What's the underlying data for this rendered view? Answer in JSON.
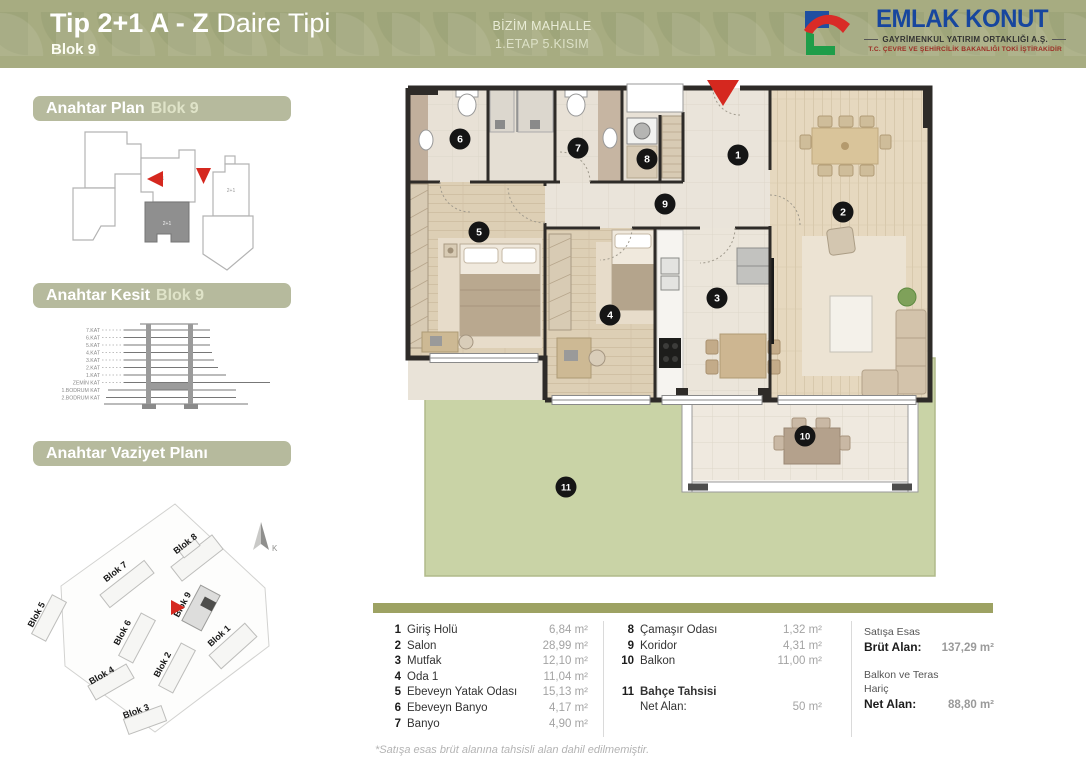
{
  "header": {
    "title_bold": "Tip 2+1 A - Z",
    "title_light": "Daire Tipi",
    "block": "Blok 9",
    "project_line1": "BİZİM MAHALLE",
    "project_line2": "1.ETAP 5.KISIM",
    "background_color": "#a7ac81",
    "logo": {
      "brand": "EMLAK KONUT",
      "subtitle": "GAYRİMENKUL YATIRIM ORTAKLIĞI A.Ş.",
      "tagline": "T.C. ÇEVRE VE ŞEHİRCİLİK BAKANLIĞI TOKİ İŞTİRAKİDİR"
    }
  },
  "sidebar": {
    "key_plan": {
      "title": "Anahtar Plan",
      "block": "Blok 9",
      "unit_labels": [
        "2+1",
        "2+1",
        "2+1"
      ]
    },
    "key_section": {
      "title": "Anahtar Kesit",
      "block": "Blok 9",
      "floors": [
        "7.KAT",
        "6.KAT",
        "5.KAT",
        "4.KAT",
        "3.KAT",
        "2.KAT",
        "1.KAT",
        "ZEMİN KAT",
        "1.BODRUM KAT",
        "2.BODRUM KAT"
      ]
    },
    "site_plan": {
      "title": "Anahtar Vaziyet Planı",
      "north_label": "K",
      "blocks": [
        "Blok 1",
        "Blok 2",
        "Blok 3",
        "Blok 4",
        "Blok 5",
        "Blok 6",
        "Blok 7",
        "Blok 8",
        "Blok 9"
      ]
    }
  },
  "floor_plan": {
    "entrance_marker_color": "#d5281f",
    "garden_color": "#c9d3a6",
    "wall_color": "#2e2b28",
    "markers": [
      {
        "n": "1",
        "x": 338,
        "y": 77
      },
      {
        "n": "2",
        "x": 443,
        "y": 134
      },
      {
        "n": "3",
        "x": 317,
        "y": 220
      },
      {
        "n": "4",
        "x": 210,
        "y": 237
      },
      {
        "n": "5",
        "x": 79,
        "y": 154
      },
      {
        "n": "6",
        "x": 60,
        "y": 61
      },
      {
        "n": "7",
        "x": 178,
        "y": 70
      },
      {
        "n": "8",
        "x": 247,
        "y": 81
      },
      {
        "n": "9",
        "x": 265,
        "y": 126
      },
      {
        "n": "10",
        "x": 405,
        "y": 358
      },
      {
        "n": "11",
        "x": 166,
        "y": 409
      }
    ]
  },
  "legend": {
    "rooms_col1": [
      {
        "no": "1",
        "name": "Giriş Holü",
        "area": "6,84 m²"
      },
      {
        "no": "2",
        "name": "Salon",
        "area": "28,99 m²"
      },
      {
        "no": "3",
        "name": "Mutfak",
        "area": "12,10 m²"
      },
      {
        "no": "4",
        "name": "Oda 1",
        "area": "11,04 m²"
      },
      {
        "no": "5",
        "name": "Ebeveyn Yatak Odası",
        "area": "15,13 m²"
      },
      {
        "no": "6",
        "name": "Ebeveyn Banyo",
        "area": "4,17 m²"
      },
      {
        "no": "7",
        "name": "Banyo",
        "area": "4,90 m²"
      }
    ],
    "rooms_col2": [
      {
        "no": "8",
        "name": "Çamaşır Odası",
        "area": "1,32 m²"
      },
      {
        "no": "9",
        "name": "Koridor",
        "area": "4,31 m²"
      },
      {
        "no": "10",
        "name": "Balkon",
        "area": "11,00 m²"
      }
    ],
    "garden_row": {
      "no": "11",
      "name": "Bahçe Tahsisi",
      "label": "Net Alan:",
      "value": "50 m²"
    },
    "summary": {
      "caption1": "Satışa Esas",
      "label1": "Brüt Alan:",
      "value1": "137,29 m²",
      "caption2": "Balkon ve Teras",
      "caption2b": "Hariç",
      "label2": "Net Alan:",
      "value2": "88,80 m²"
    }
  },
  "footnote": "*Satışa esas brüt alanına tahsisli alan dahil edilmemiştir."
}
